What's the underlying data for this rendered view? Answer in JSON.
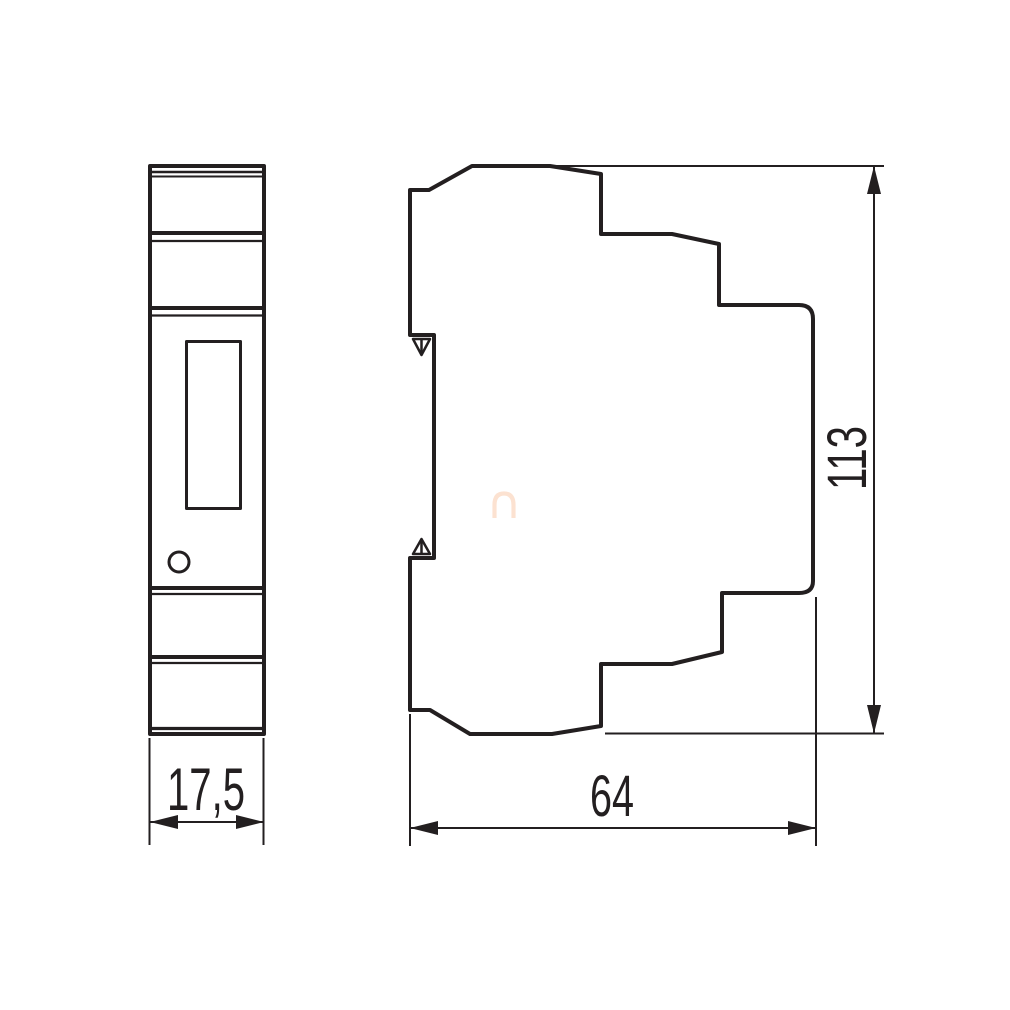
{
  "colors": {
    "line": "#231f20",
    "background": "#ffffff",
    "watermark": "#fce2d1"
  },
  "dimensions": {
    "width": {
      "label": "17,5"
    },
    "depth": {
      "label": "64"
    },
    "height": {
      "label": "113"
    }
  },
  "watermark": {
    "glyph": "n"
  }
}
